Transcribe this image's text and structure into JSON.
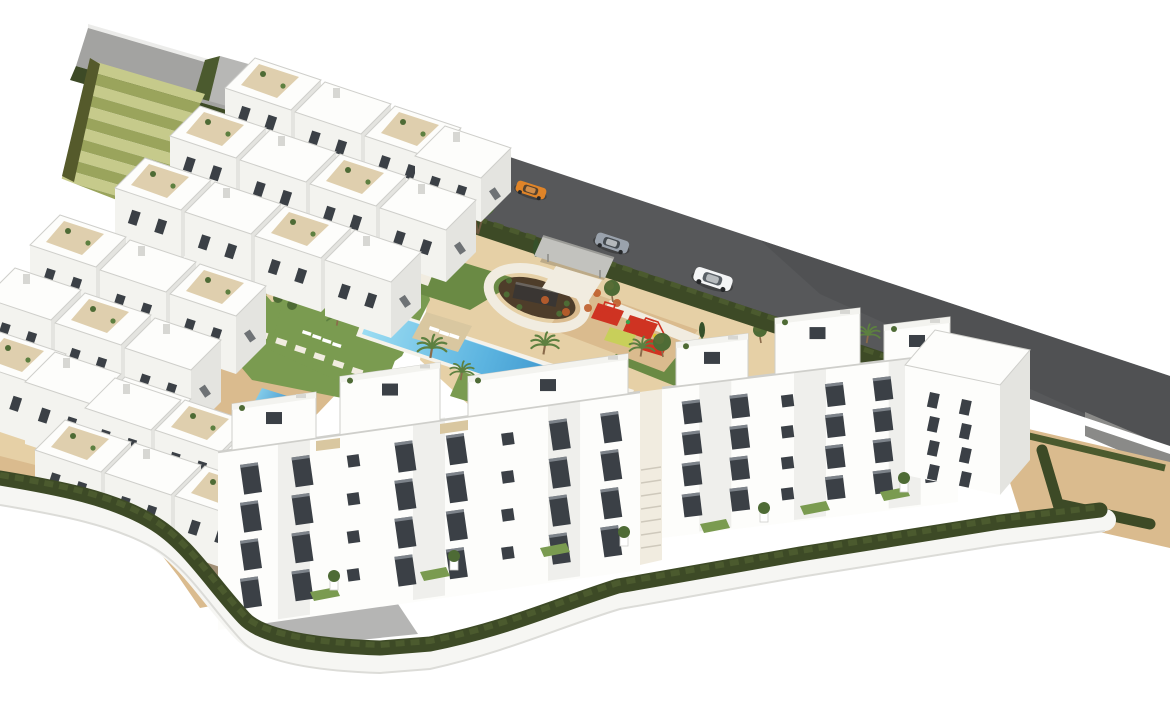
{
  "meta": {
    "type": "architectural-aerial-render",
    "description": "Aerial 3D architectural rendering of a modern white apartment complex with landscaped gardens, a large communal swimming pool, children's playground, circular feature plaza, terraced green steps, perimeter hedges and a street with three cars",
    "canvas": {
      "width": 1170,
      "height": 728
    },
    "background": "#ffffff"
  },
  "palette": {
    "background": "#ffffff",
    "roadDark": "#57585a",
    "roadDarker": "#4b4c4e",
    "roadLight": "#a3a3a1",
    "roadRamp": "#b7b7b5",
    "curb": "#ececea",
    "retainingWall": "#8a8a88",
    "hedgeDark": "#3d4a26",
    "hedgeMid": "#4b5a2e",
    "hedgeLight": "#5d6d38",
    "stepsLight": "#c6ca8b",
    "stepsDark": "#9aa45c",
    "stepsBorder": "#555a2b",
    "lawn": "#7a9b50",
    "lawnDark": "#6a8a44",
    "sand": "#dabb8e",
    "sandLight": "#e6d0a6",
    "paver": "#f1ece0",
    "poolShallow": "#8ed4ee",
    "poolDeep": "#1f78ba",
    "poolCoping": "#f5f2ea",
    "deck": "#d9c7a0",
    "buildingWhite": "#fdfdfb",
    "buildingFace": "#f3f3ef",
    "buildingSide": "#e4e4e0",
    "buildingShade": "#d7d7d3",
    "parapet": "#cfcfcb",
    "windowDark": "#3b4046",
    "windowFrame": "#9aa0a6",
    "plazaSoil": "#4e3d2a",
    "monument": "#3a3633",
    "playRed": "#cf3322",
    "playYellow": "#c8cf5a",
    "playOrange": "#bf5e2b",
    "treeGreen": "#4e6b35",
    "palmGreen": "#5d8040",
    "trunk": "#8a6b4a",
    "carOrange": "#e08428",
    "carSilver": "#9aa2ac",
    "carWhite": "#f4f5f6",
    "shadow": "rgba(90,90,88,0.45)"
  },
  "scene": {
    "backdrop": "white",
    "road": {
      "surface": "asphalt street running diagonally behind the complex",
      "cars": [
        {
          "id": "sports-car",
          "body": "carOrange"
        },
        {
          "id": "sedan",
          "body": "carSilver"
        },
        {
          "id": "suv",
          "body": "carWhite"
        }
      ]
    },
    "amenities": [
      {
        "id": "swimming-pool",
        "label": "Communal swimming pool"
      },
      {
        "id": "terrace-pool",
        "label": "Small terrace plunge pool"
      },
      {
        "id": "sun-deck",
        "label": "Sun deck with loungers"
      },
      {
        "id": "circular-plaza",
        "label": "Circular plaza with dark feature wall"
      },
      {
        "id": "playground",
        "label": "Children's playground with red safety mats"
      },
      {
        "id": "terraced-steps",
        "label": "Landscaped terraced steps"
      },
      {
        "id": "gardens",
        "label": "Mediterranean gardens with palms and olive trees"
      },
      {
        "id": "entrance-canopy",
        "label": "Street entrance canopy"
      }
    ],
    "buildings": {
      "left_cluster": {
        "blocks": 27,
        "style": "terraced white apartments with roof terraces and plants"
      },
      "foreground": {
        "blocks": 3,
        "stories": 4,
        "window_columns_center": 8,
        "window_columns_right": 6,
        "style": "white apartment blocks with dark framed windows"
      }
    },
    "landscape": {
      "perimeter": "clipped hedge on a white boundary wall",
      "ground": "sand-coloured terrain with lawns, pavers and stepping stones"
    }
  }
}
